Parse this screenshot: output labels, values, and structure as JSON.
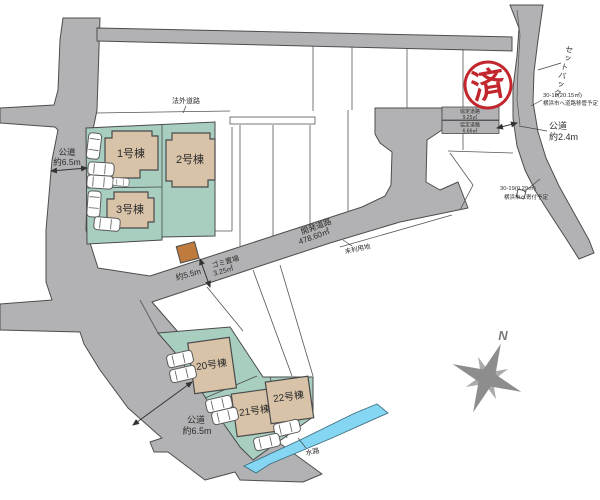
{
  "stamp": {
    "text": "済"
  },
  "compass": {
    "north": "N"
  },
  "buildings": {
    "b1": "1号棟",
    "b2": "2号棟",
    "b3": "3号棟",
    "b20": "20号棟",
    "b21": "21号棟",
    "b22": "22号棟"
  },
  "roads": {
    "illegal_road": "法外道路",
    "left_public": {
      "name": "公道",
      "width": "約6.5m"
    },
    "bottom_public": {
      "name": "公道",
      "width": "約6.5m"
    },
    "right_public": {
      "name": "公道",
      "width": "約2.4m"
    },
    "dev_road": {
      "name": "開発道路",
      "area": "478.60㎡",
      "width": "約5.5m"
    },
    "setback": "セットバック"
  },
  "agreement_roads": [
    {
      "name": "協定道路",
      "area": "9.25㎡"
    },
    {
      "name": "協定道路",
      "area": "6.66㎡"
    }
  ],
  "parcels": {
    "p30_18": {
      "id": "30-18(20.15㎡)",
      "note": "横浜市へ道路移管予定"
    },
    "p30_19": {
      "id": "30-19(0.29㎡)",
      "note": "横浜市へ寄付予定"
    },
    "unused": "未利用地"
  },
  "facilities": {
    "garbage": {
      "name": "ゴミ置場",
      "area": "3.25㎡"
    },
    "waterway": "水路"
  },
  "colors": {
    "road": "#b2b2b4",
    "lot_green": "#a8cec0",
    "building_tan": "#d8c3a8",
    "water_blue": "#85d6f2",
    "stamp_red": "#c1272d",
    "garbage_orange": "#bf7b3e",
    "compass_gray": "#8d8d8d"
  }
}
